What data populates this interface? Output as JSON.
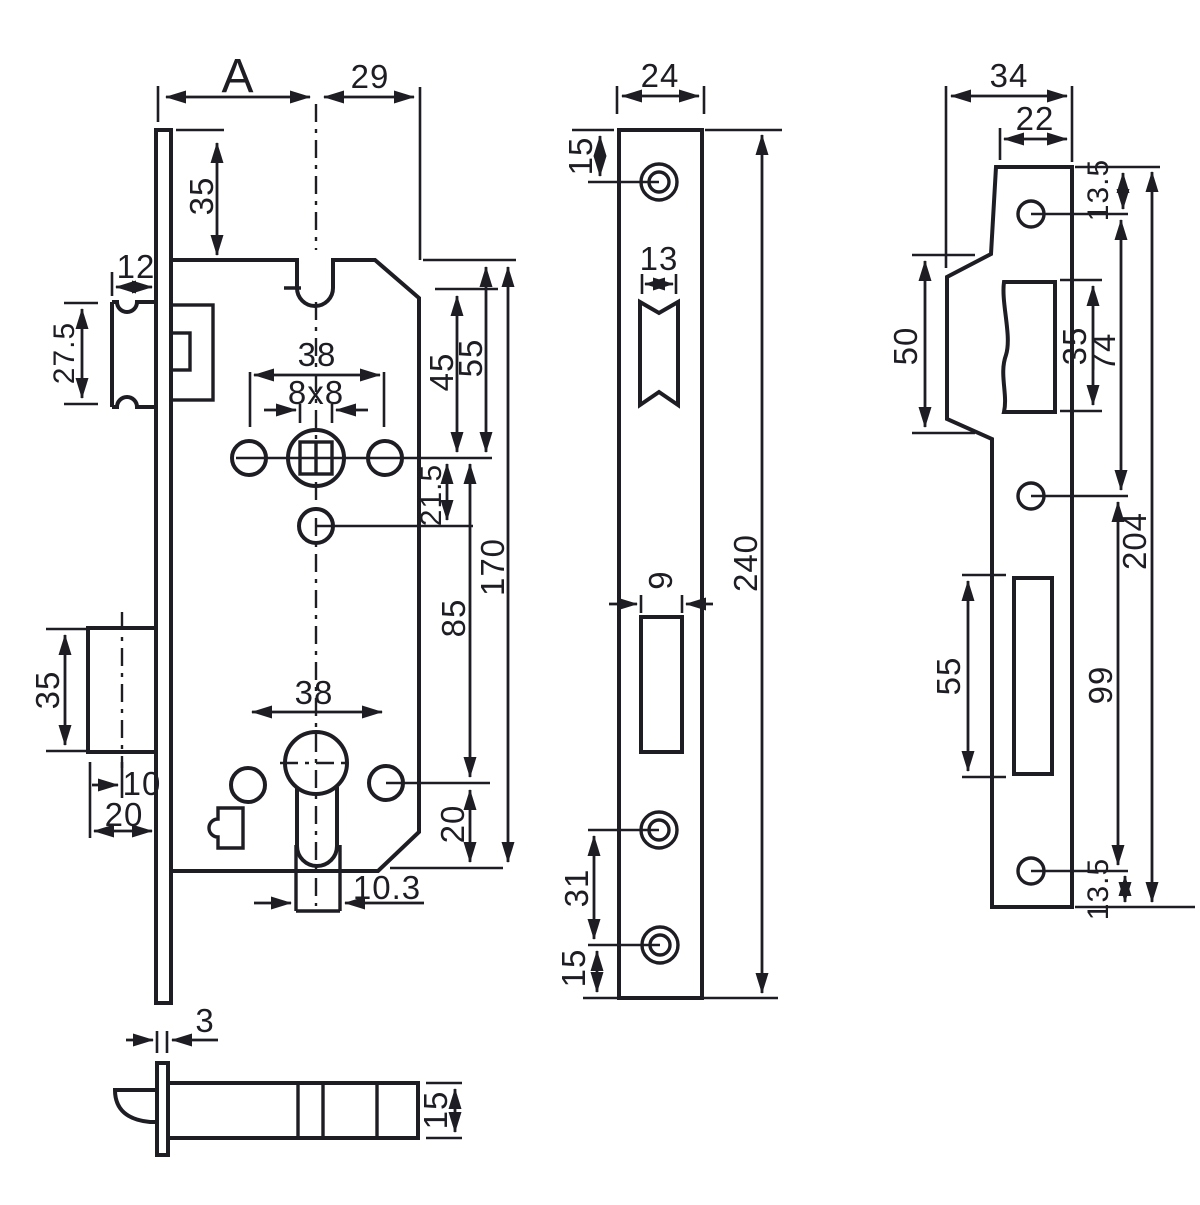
{
  "colors": {
    "ink": "#1d1d23",
    "background": "#ffffff"
  },
  "drawing_type": "mortise-lock-technical-drawing",
  "views": {
    "lock_body": {
      "a": "A",
      "n29": "29",
      "n35_top": "35",
      "n12": "12",
      "n27_5": "27.5",
      "n38_spindle": "38",
      "n8x8": "8x8",
      "n45": "45",
      "n55": "55",
      "n21_5": "21.5",
      "n85": "85",
      "n170": "170",
      "n35_deadbolt": "35",
      "n10": "10",
      "n20_front": "20",
      "n38_cylinder": "38",
      "n20_bottom": "20",
      "n10_3": "10.3"
    },
    "faceplate": {
      "n24": "24",
      "n15_top": "15",
      "n13": "13",
      "n9": "9",
      "n240": "240",
      "n31": "31",
      "n15_bottom": "15"
    },
    "strike_plate": {
      "n34": "34",
      "n22": "22",
      "n13_5_top": "13.5",
      "n50": "50",
      "n35_latch": "35",
      "n74": "74",
      "n204": "204",
      "n55_bolt": "55",
      "n99": "99",
      "n13_5_bottom": "13.5"
    },
    "latch_detail": {
      "n3": "3",
      "n15": "15"
    }
  }
}
